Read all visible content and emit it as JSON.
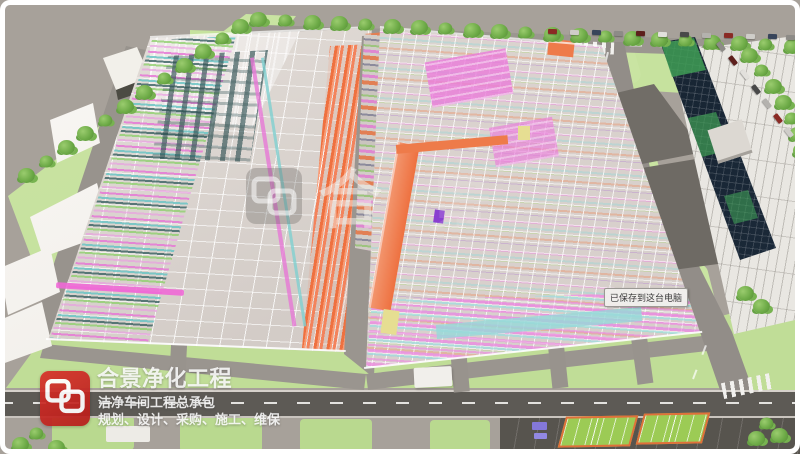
{
  "branding": {
    "title": "合景净化工程",
    "subtitle": "洁净车间工程总承包",
    "tagline": "规划、设计、采购、施工、维保",
    "logo_color": "#c42522"
  },
  "watermark": {
    "char_primary": "合",
    "char_secondary": "景"
  },
  "tooltip": {
    "text": "已保存到这台电脑"
  },
  "palette": {
    "pavement": "#a7a19a",
    "road_dark": "#5d5a55",
    "road_light": "#98938d",
    "grass": "#c3e09c",
    "slab": "#d6cfca",
    "pipe_magenta": "#ea7fd9",
    "pipe_orange": "#f07e50",
    "pipe_cyan": "#a5dede",
    "pipe_green": "#a6d87a",
    "pipe_yellow": "#e8df90",
    "pipe_purple": "#b070d8",
    "tower_facade": "#1c2b3d",
    "tower_glass": "#3f9e55",
    "court_green": "#9ccb55",
    "court_border": "#e0703a"
  },
  "scene": {
    "trees": [
      [
        18,
        168
      ],
      [
        38,
        154
      ],
      [
        58,
        140
      ],
      [
        77,
        126
      ],
      [
        97,
        113
      ],
      [
        117,
        99
      ],
      [
        136,
        85
      ],
      [
        156,
        71
      ],
      [
        176,
        58
      ],
      [
        195,
        44
      ],
      [
        214,
        31
      ],
      [
        232,
        19
      ],
      [
        250,
        12
      ],
      [
        277,
        13
      ],
      [
        304,
        15
      ],
      [
        331,
        16
      ],
      [
        357,
        17
      ],
      [
        384,
        19
      ],
      [
        411,
        20
      ],
      [
        437,
        21
      ],
      [
        464,
        23
      ],
      [
        491,
        24
      ],
      [
        517,
        25
      ],
      [
        544,
        27
      ],
      [
        571,
        28
      ],
      [
        597,
        29
      ],
      [
        624,
        31
      ],
      [
        651,
        32
      ],
      [
        677,
        33
      ],
      [
        704,
        35
      ],
      [
        731,
        36
      ],
      [
        757,
        37
      ],
      [
        784,
        39
      ],
      [
        741,
        48
      ],
      [
        753,
        63
      ],
      [
        765,
        79
      ],
      [
        775,
        95
      ],
      [
        783,
        111
      ],
      [
        789,
        127
      ],
      [
        793,
        143
      ],
      [
        795,
        160
      ],
      [
        737,
        286
      ],
      [
        753,
        299
      ],
      [
        758,
        416
      ],
      [
        771,
        428
      ],
      [
        748,
        431
      ],
      [
        28,
        426
      ],
      [
        48,
        440
      ],
      [
        12,
        437
      ]
    ],
    "cars_top_road": [
      [
        548,
        29
      ],
      [
        570,
        30
      ],
      [
        592,
        30
      ],
      [
        614,
        31
      ],
      [
        636,
        31
      ],
      [
        658,
        32
      ],
      [
        680,
        32
      ],
      [
        702,
        33
      ],
      [
        724,
        33
      ],
      [
        746,
        34
      ],
      [
        768,
        34
      ],
      [
        786,
        35
      ]
    ],
    "cars_right_lane": [
      [
        716,
        44
      ],
      [
        728,
        58
      ],
      [
        740,
        72
      ],
      [
        751,
        87
      ],
      [
        762,
        101
      ],
      [
        773,
        116
      ],
      [
        784,
        130
      ]
    ],
    "car_colors": [
      "#8a2a24",
      "#cfcdc9",
      "#37445a",
      "#8d8b87",
      "#5d1f1c",
      "#e2e0dc",
      "#494949",
      "#b4b2ae"
    ]
  }
}
